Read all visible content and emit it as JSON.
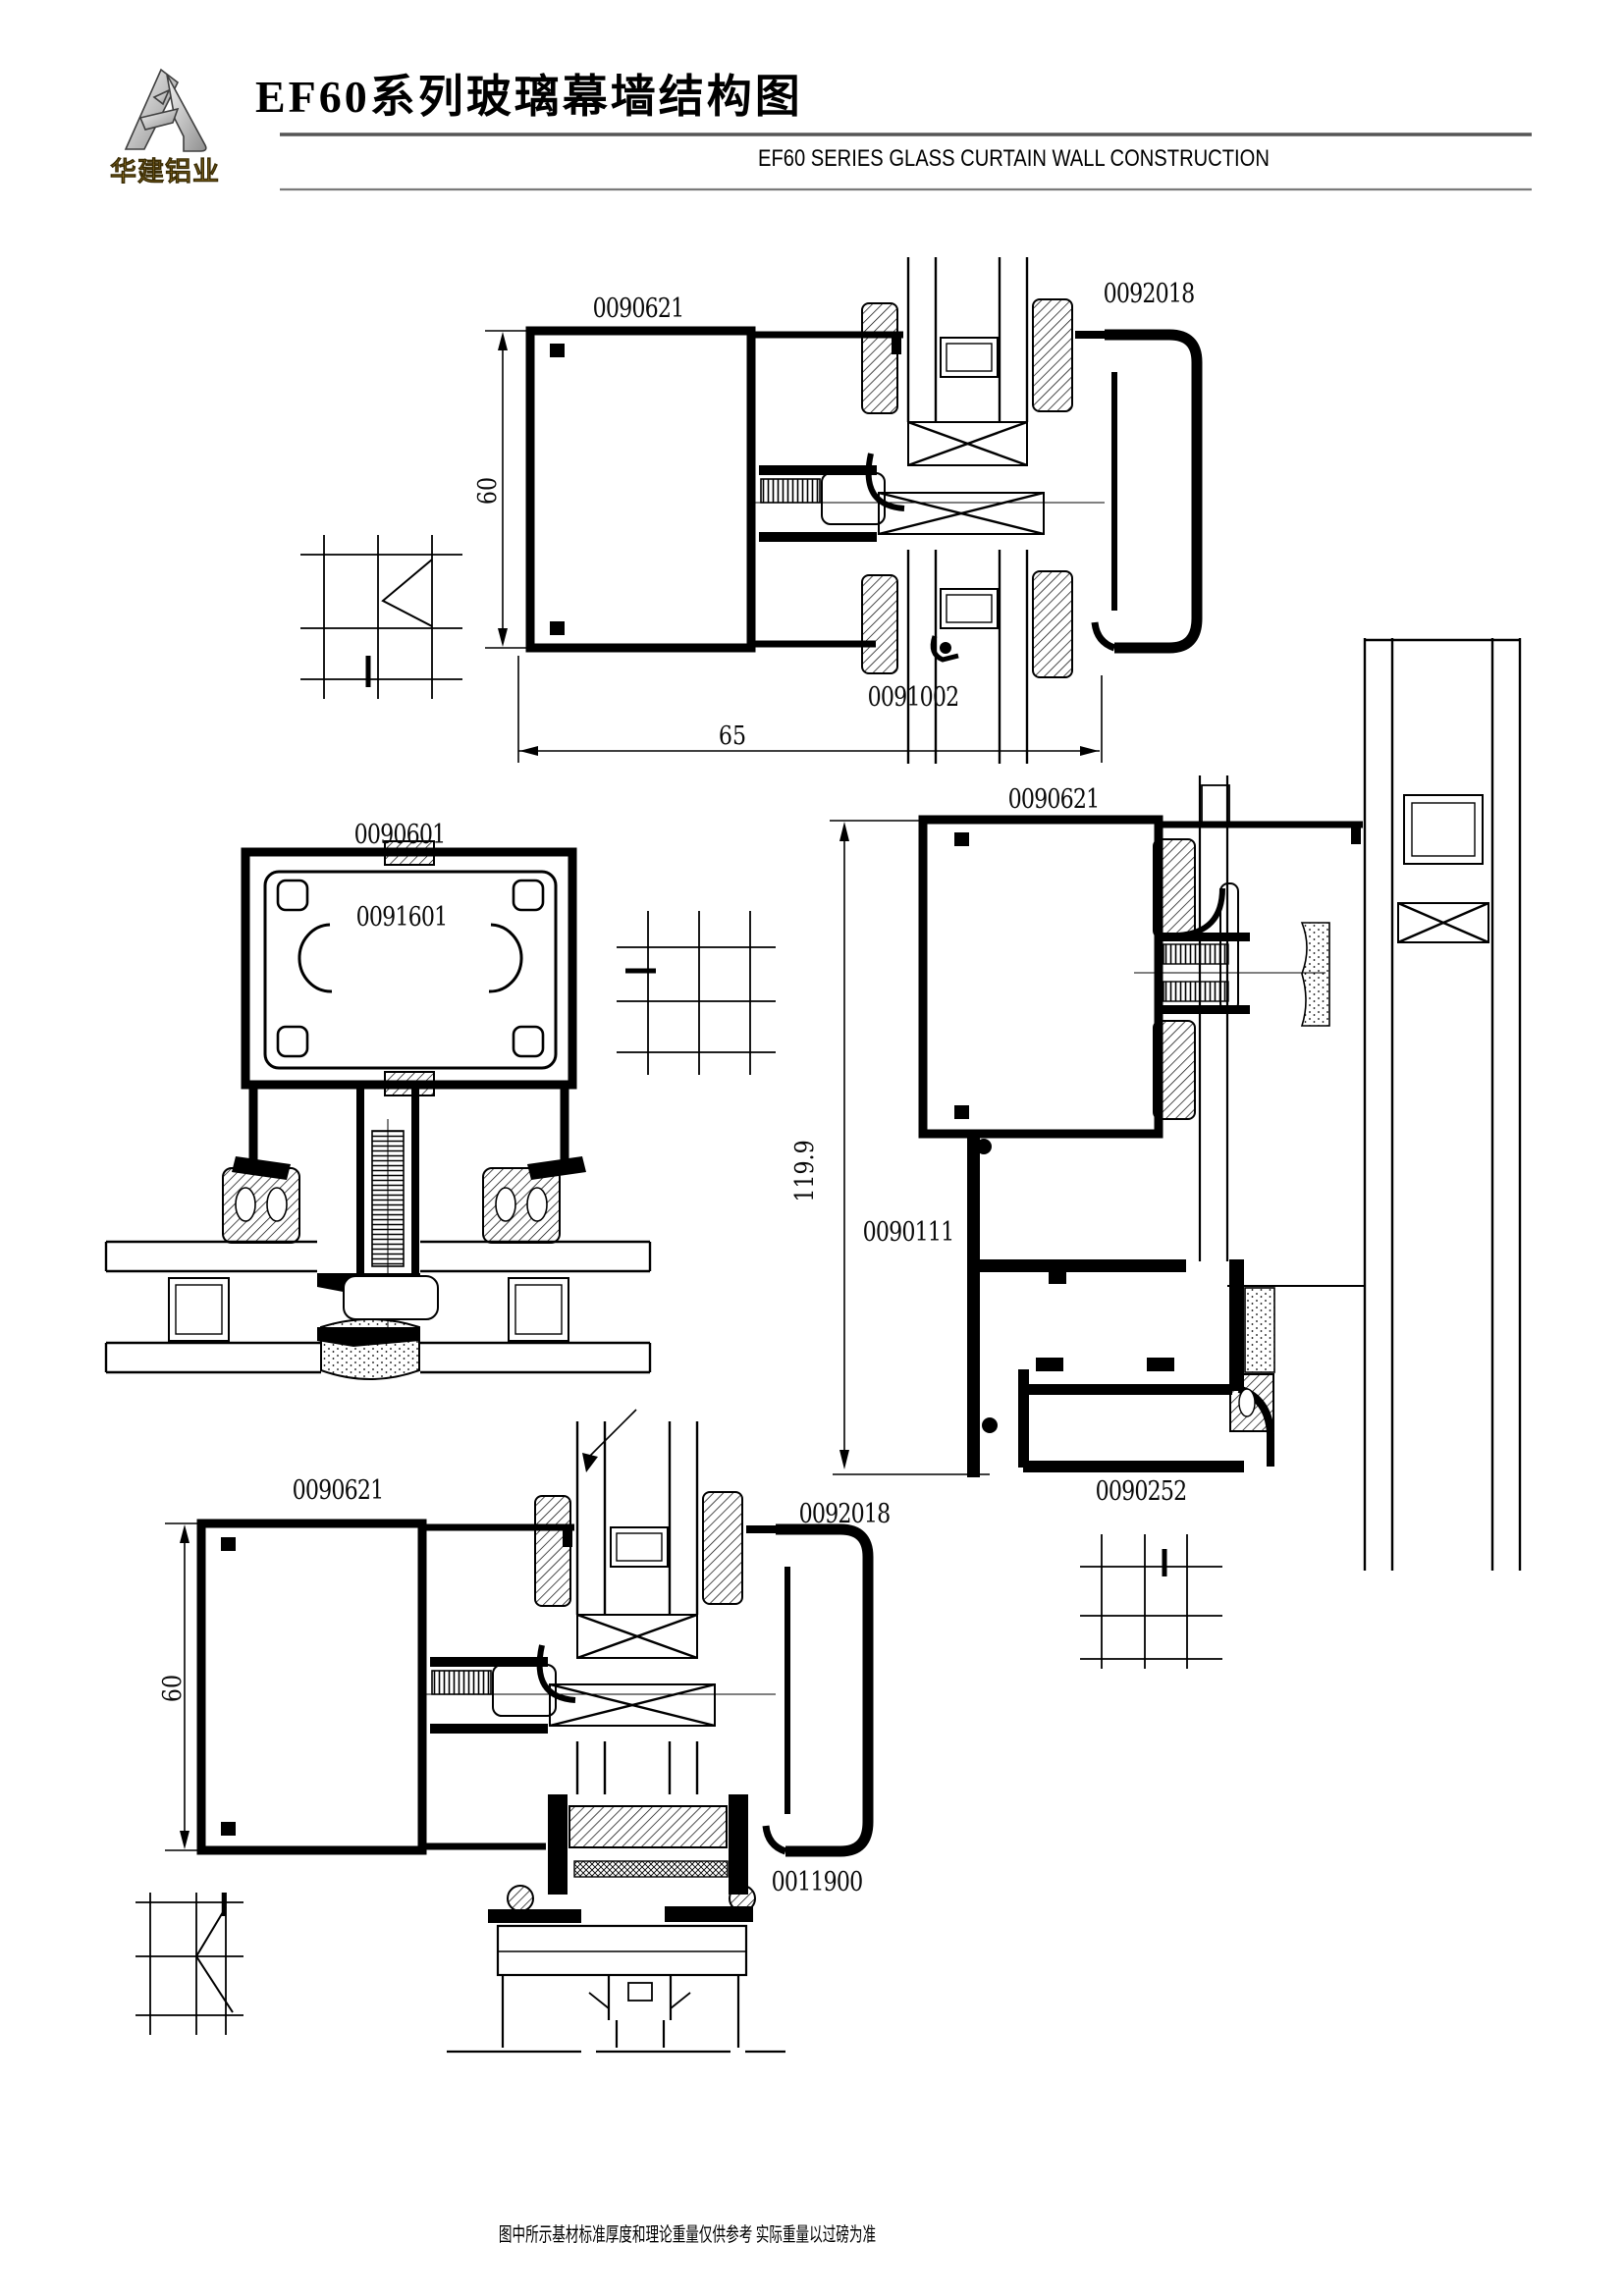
{
  "page": {
    "title": "EF60系列玻璃幕墙结构图",
    "subtitle": "EF60  SERIES GLASS CURTAIN WALL CONSTRUCTION",
    "footer": "图中所示基材标准厚度和理论重量仅供参考 实际重量以过磅为准",
    "logo_text": "华建铝业"
  },
  "details": {
    "top": {
      "labels": {
        "mullion": "0090621",
        "cover": "0092018",
        "adapter": "0091002"
      },
      "dims": {
        "height": "60",
        "width": "65"
      }
    },
    "mid_left": {
      "labels": {
        "outer": "0090601",
        "insert": "0091601"
      }
    },
    "mid_right": {
      "labels": {
        "mullion": "0090621",
        "frame": "0090111",
        "vent": "0090252"
      },
      "dims": {
        "height": "119.9"
      }
    },
    "bottom": {
      "labels": {
        "mullion": "0090621",
        "cover": "0092018",
        "sub_frame": "0011900"
      },
      "dims": {
        "height": "60"
      }
    }
  }
}
